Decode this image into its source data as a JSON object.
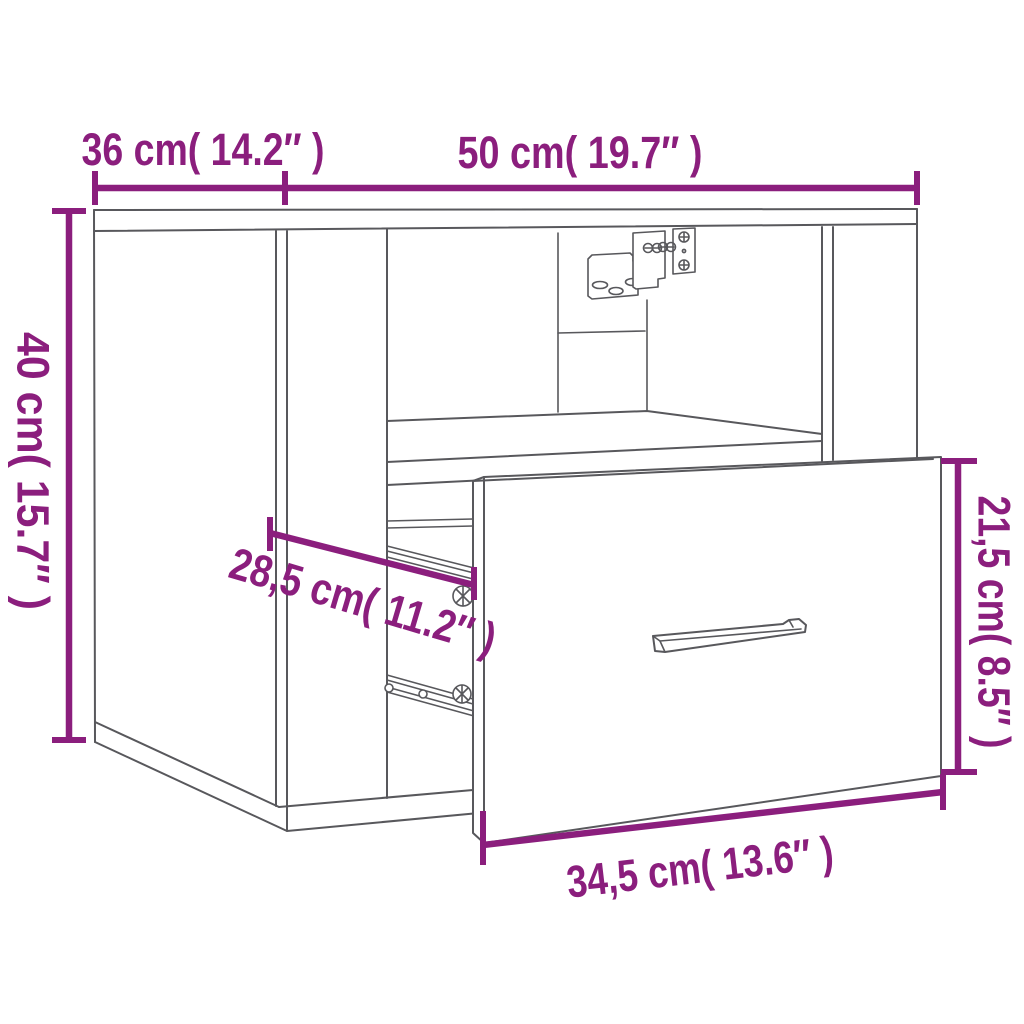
{
  "page": {
    "background_color": "#ffffff"
  },
  "diagram": {
    "subject": "wall-mounted bedside cabinet with open shelf compartment and pulled-out drawer",
    "accent_color": "#8B1E7D",
    "line_color": "#58585C",
    "labels": {
      "depth_top": "36 cm( 14.2″ )",
      "width_top": "50 cm( 19.7″ )",
      "height_left": "40 cm( 15.7″ )",
      "drawer_height_right": "21,5 cm( 8.5″ )",
      "inner_depth_diagonal": "28,5 cm( 11.2″ )",
      "drawer_width_bottom": "34,5 cm( 13.6″ )"
    }
  }
}
